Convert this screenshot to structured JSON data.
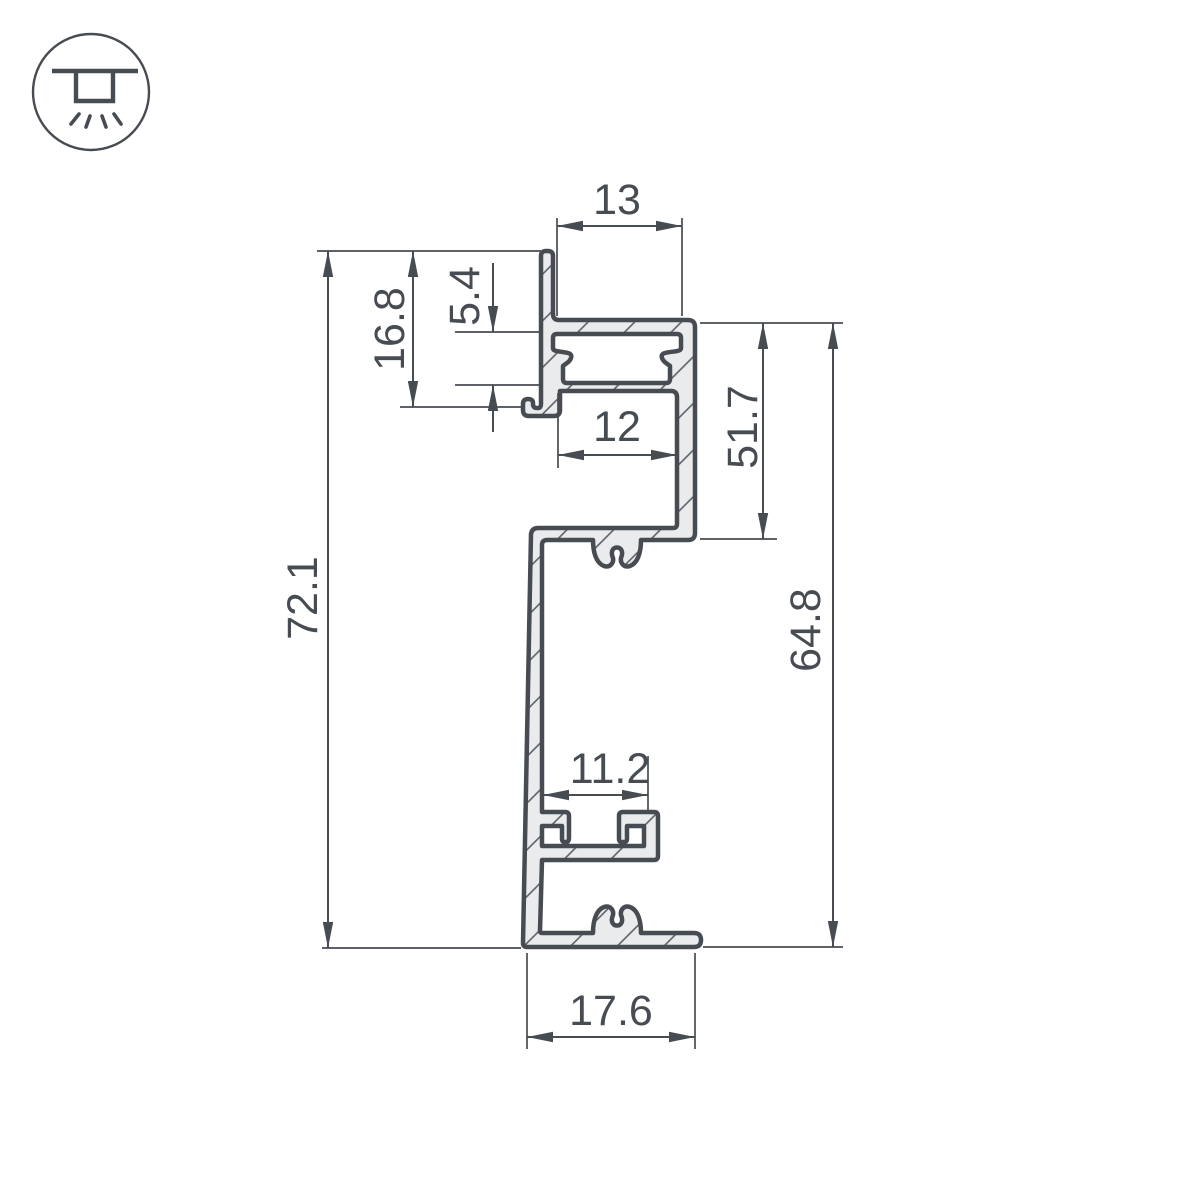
{
  "drawing": {
    "title": "LED profile cross-section technical drawing",
    "icon": "recessed-ceiling-light-icon",
    "colors": {
      "line": "#474c52",
      "fill": "#e9ebec",
      "background": "#ffffff"
    },
    "dimensions": {
      "top_width": "13",
      "upper_height": "16.8",
      "slot_depth": "5.4",
      "window_width": "12",
      "right_inner_height": "51.7",
      "total_height": "72.1",
      "body_height": "64.8",
      "screw_channel_width": "11.2",
      "base_width": "17.6"
    }
  }
}
